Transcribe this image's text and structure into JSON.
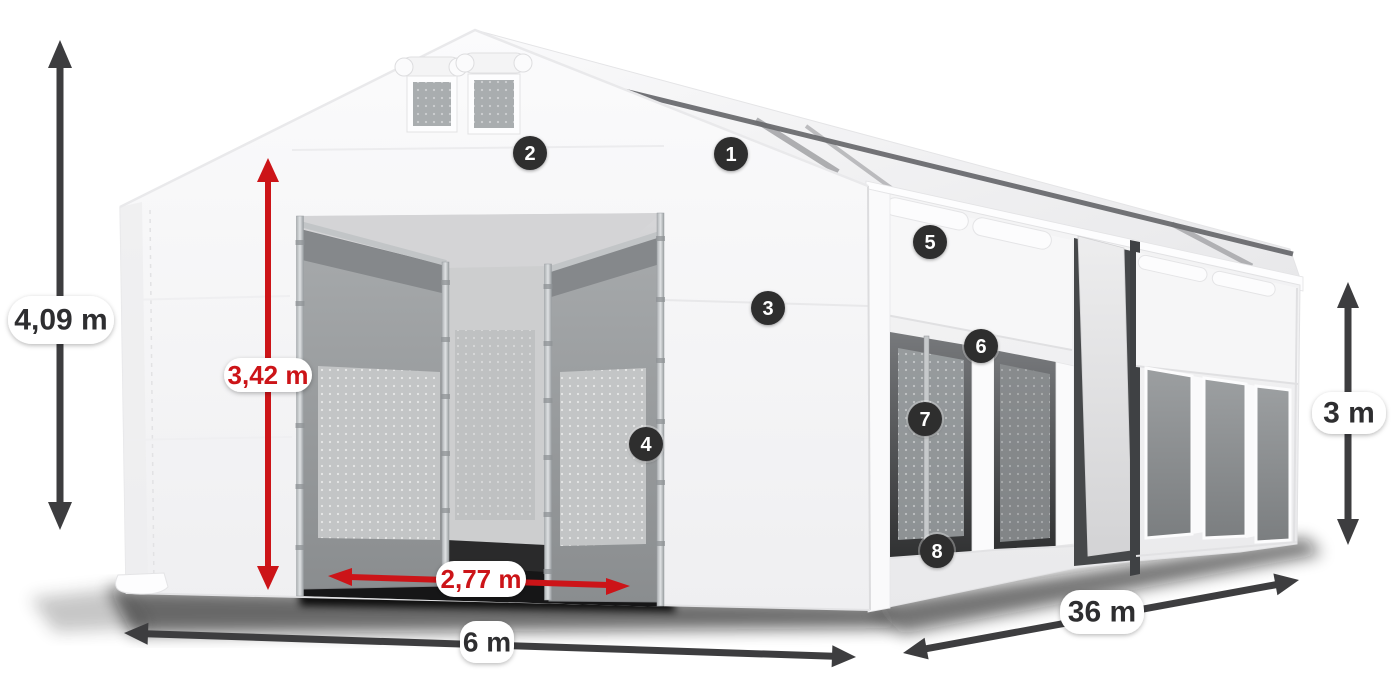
{
  "diagram": {
    "alt": "White PVC storage tent shown in perspective with open entrance doors and measurement arrows"
  },
  "colors": {
    "background": "#ffffff",
    "dimension_dark": "#3d3d3f",
    "dimension_red": "#cc1418",
    "label_text_dark": "#2e2e30",
    "callout_background": "#2d2d2f",
    "callout_text": "#ffffff",
    "tent_white": "#f6f6f7",
    "ground_shadow": "#0d0d0d"
  },
  "dimensions": {
    "total_height": {
      "label": "4,09 m",
      "color": "dark",
      "orientation": "vertical"
    },
    "entrance_height": {
      "label": "3,42 m",
      "color": "red",
      "orientation": "vertical"
    },
    "entrance_width": {
      "label": "2,77 m",
      "color": "red",
      "orientation": "horizontal"
    },
    "tent_width": {
      "label": "6 m",
      "color": "dark",
      "orientation": "horizontal"
    },
    "tent_length": {
      "label": "36 m",
      "color": "dark",
      "orientation": "diagonal"
    },
    "side_wall_height": {
      "label": "3 m",
      "color": "dark",
      "orientation": "vertical"
    }
  },
  "callouts": [
    {
      "number": "1"
    },
    {
      "number": "2"
    },
    {
      "number": "3"
    },
    {
      "number": "4"
    },
    {
      "number": "5"
    },
    {
      "number": "6"
    },
    {
      "number": "7"
    },
    {
      "number": "8"
    }
  ]
}
